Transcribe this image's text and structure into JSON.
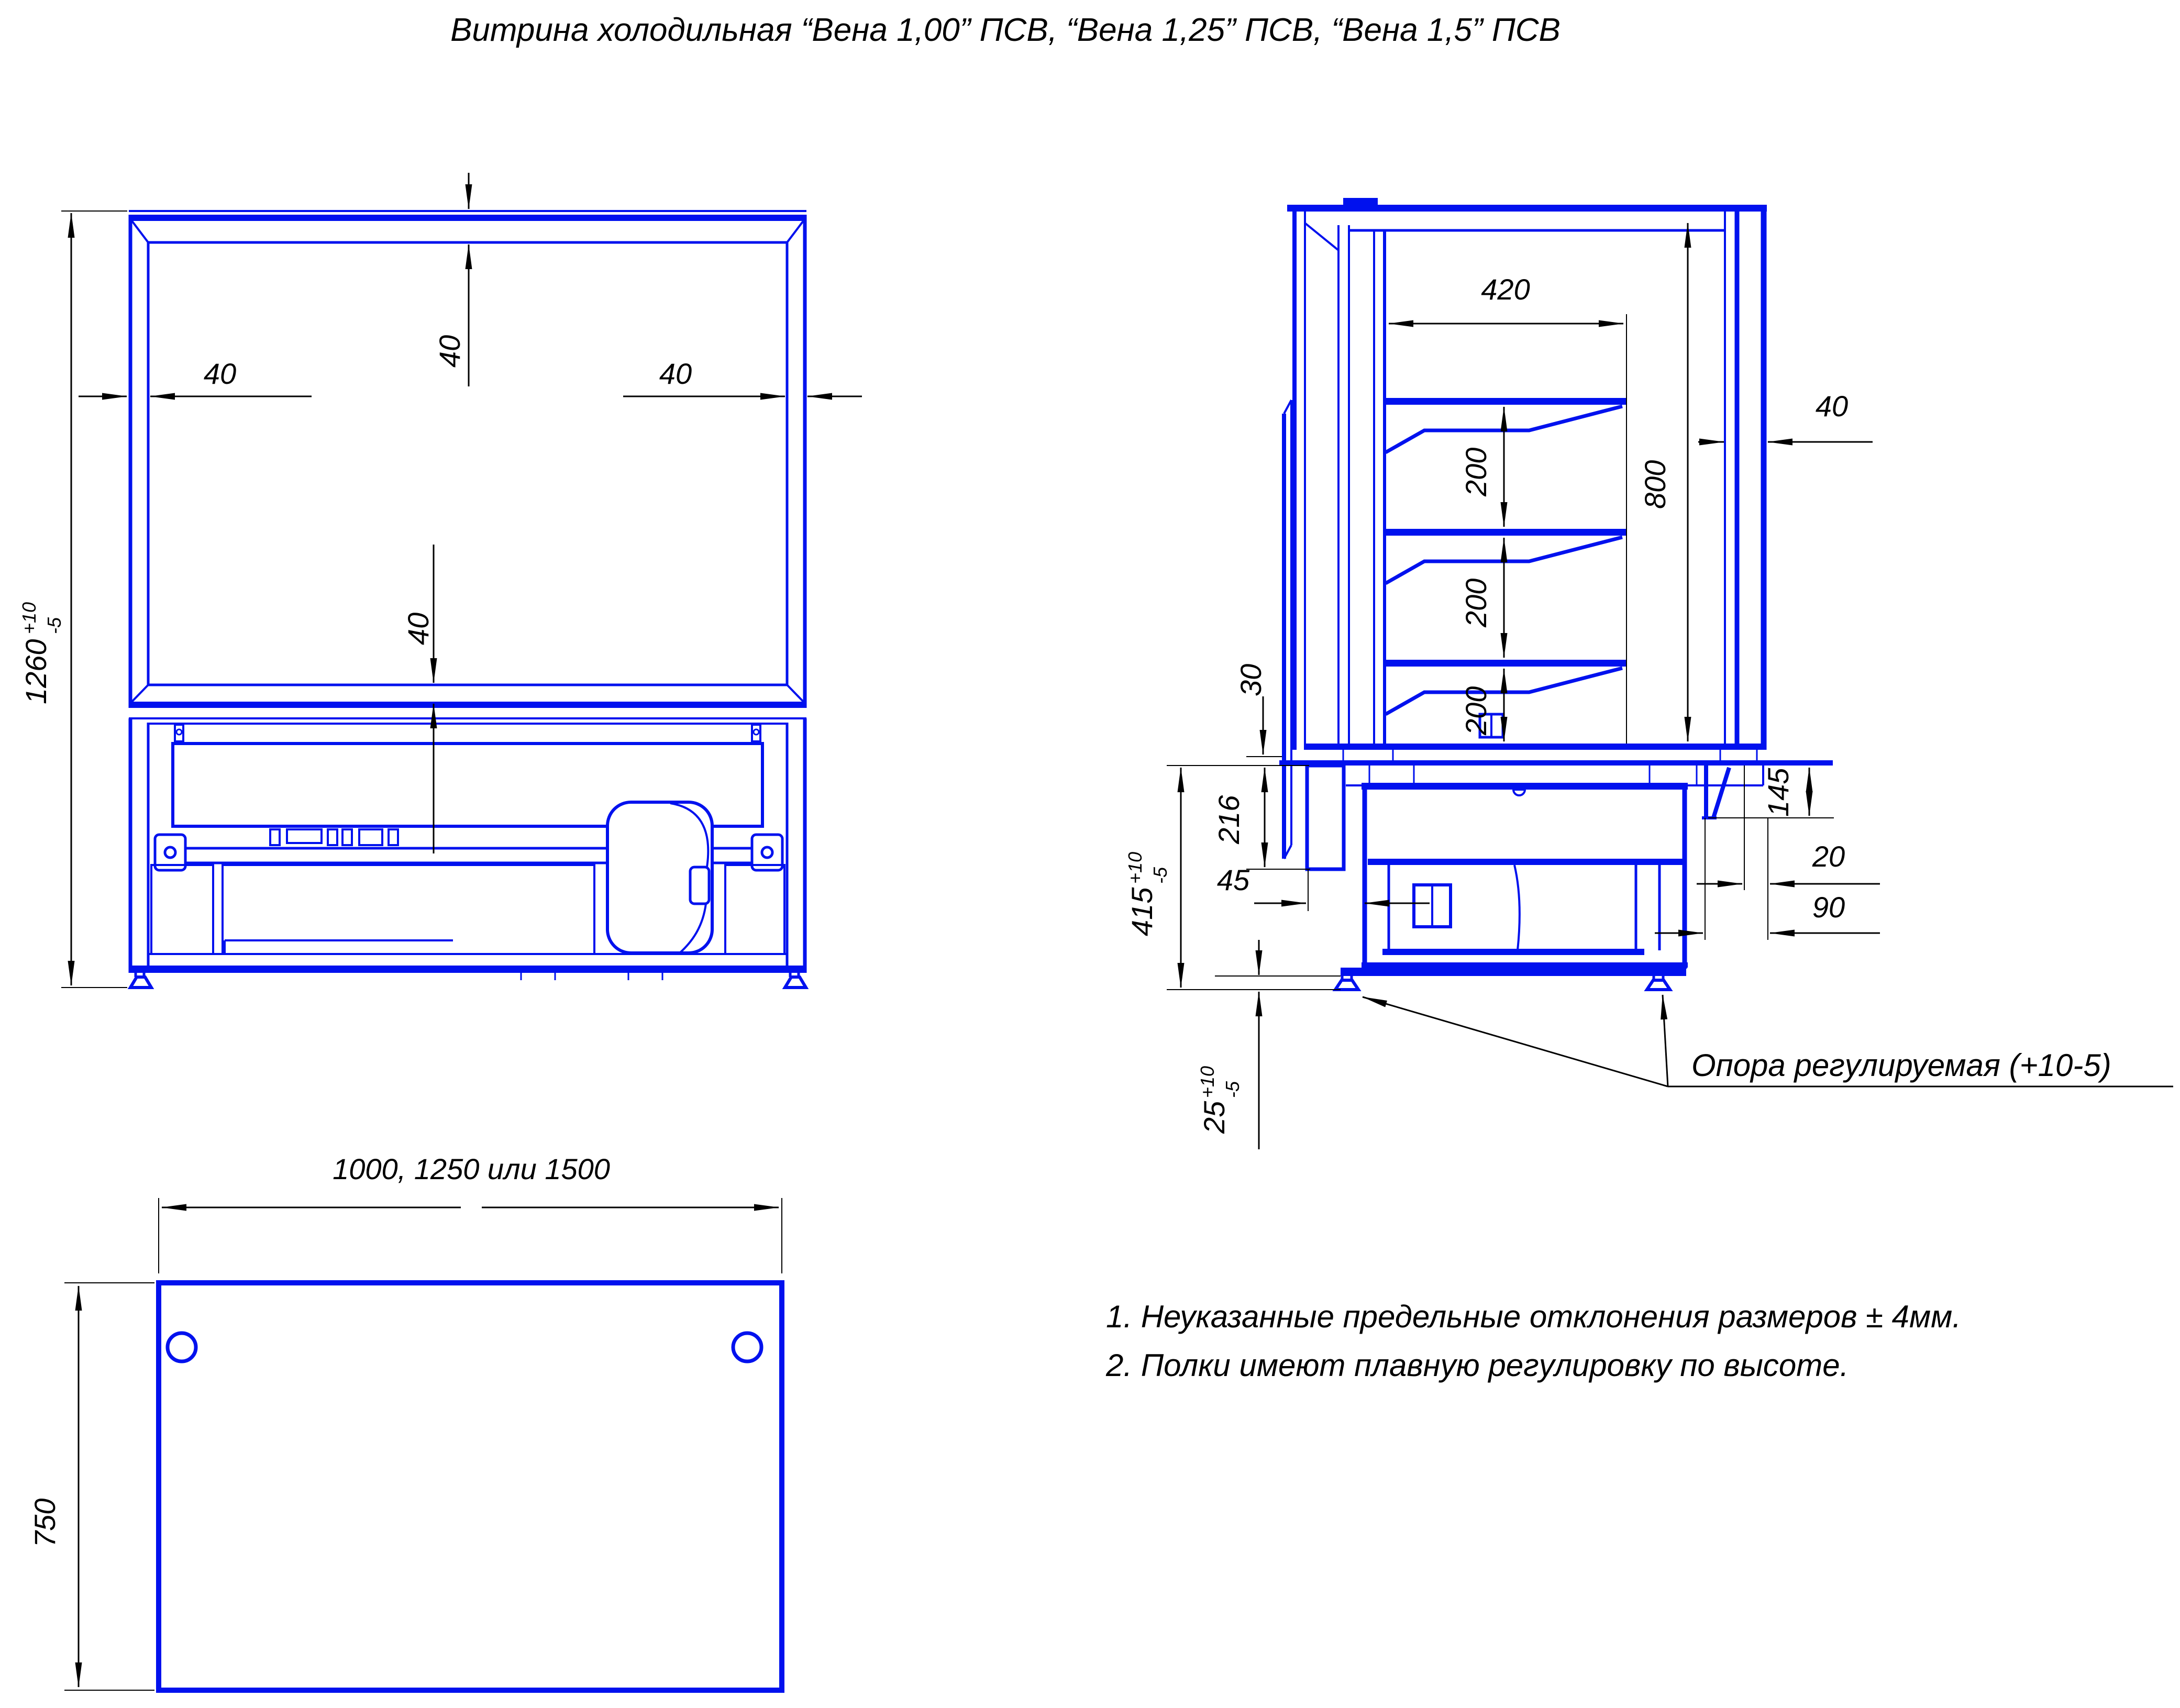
{
  "title": "Витрина холодильная “Вена 1,00” ПСВ, “Вена 1,25” ПСВ, “Вена 1,5” ПСВ",
  "colors": {
    "part_line": "#0011ee",
    "dimension_line": "#000000",
    "background": "#ffffff"
  },
  "front": {
    "height": "1260",
    "height_up": "+10",
    "height_dn": "-5",
    "top": "40",
    "left": "40",
    "right": "40",
    "bottom": "40"
  },
  "side": {
    "shelf_width": "420",
    "gap1": "200",
    "gap2": "200",
    "gap3": "200",
    "interior_height": "800",
    "glass": "40",
    "counter": "30",
    "panel": "216",
    "clearance": "45",
    "base": "415",
    "base_up": "+10",
    "base_dn": "-5",
    "skirt": "145",
    "offset_small": "20",
    "offset_large": "90",
    "foot": "25",
    "foot_up": "+10",
    "foot_dn": "-5",
    "leader": "Опора регулируемая (+10-5)"
  },
  "bottom": {
    "width": "1000, 1250 или 1500",
    "depth": "750"
  },
  "notes": [
    "1. Неуказанные предельные отклонения размеров ± 4мм.",
    "2. Полки имеют плавную регулировку по высоте."
  ]
}
